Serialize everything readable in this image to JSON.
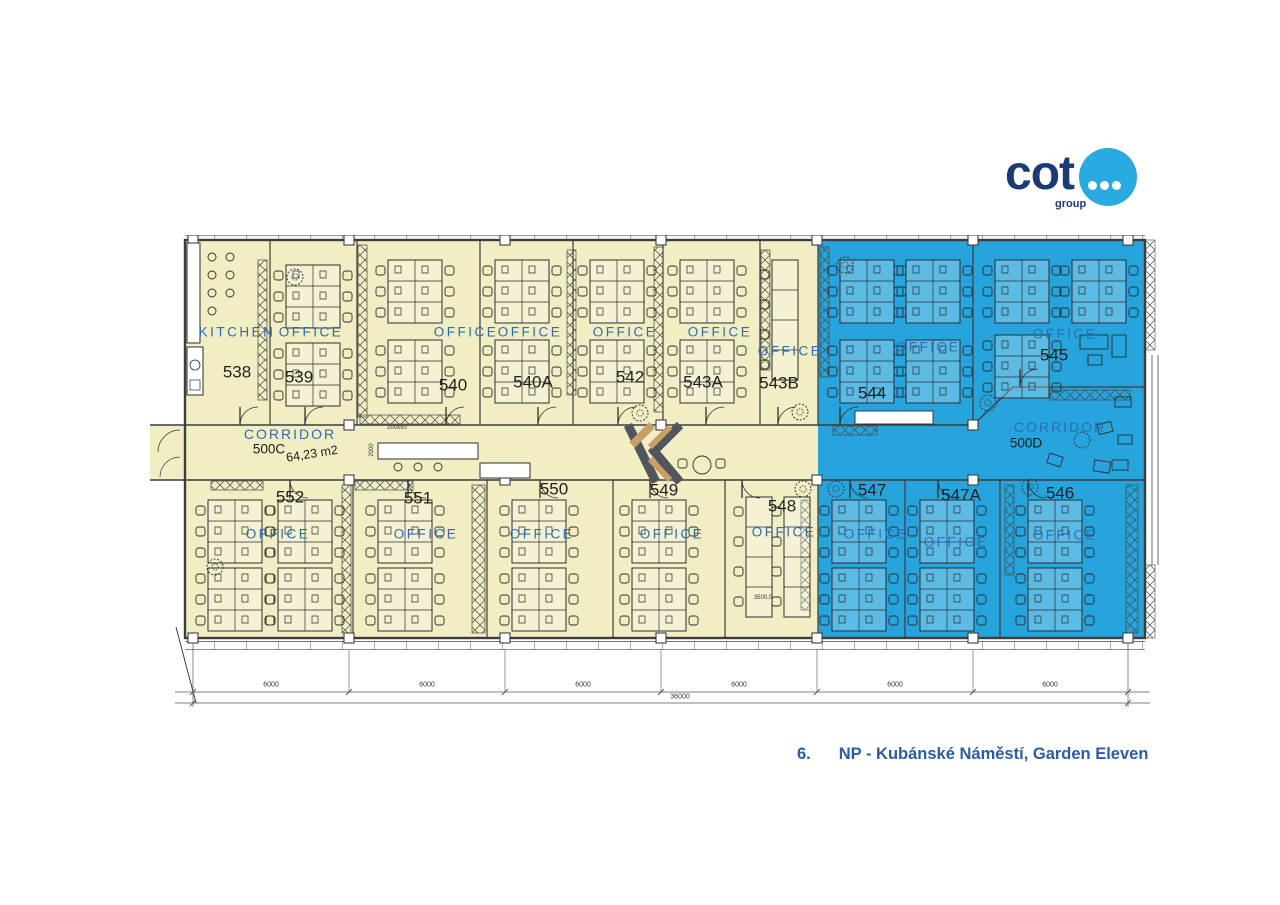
{
  "logo": {
    "brand": "cot",
    "sub": "group",
    "navy": "#1c3b76",
    "blue": "#29abe2"
  },
  "caption": {
    "index": "6.",
    "text": "NP - Kubánské Náměstí, Garden Eleven",
    "color": "#2a5ca8"
  },
  "plan": {
    "colors": {
      "yellow_zone": "#f1eec3",
      "blue_zone": "#25a4dd",
      "label_blue": "#2e6cb4",
      "wall": "#3d3d3d"
    },
    "corridors": {
      "left": {
        "label": "CORRIDOR",
        "number": "500C",
        "area": "64,23 m2"
      },
      "right": {
        "label": "CORRIDOR",
        "number": "500D"
      }
    },
    "rooms_top": [
      {
        "number": "538",
        "type": "KITCHEN",
        "zone": "yellow"
      },
      {
        "number": "539",
        "type": "OFFICE",
        "zone": "yellow"
      },
      {
        "number": "540",
        "type": "OFFICE",
        "zone": "yellow"
      },
      {
        "number": "540A",
        "type": "OFFICE",
        "zone": "yellow"
      },
      {
        "number": "542",
        "type": "OFFICE",
        "zone": "yellow"
      },
      {
        "number": "543A",
        "type": "OFFICE",
        "zone": "yellow"
      },
      {
        "number": "543B",
        "type": "OFFICE",
        "zone": "yellow"
      },
      {
        "number": "544",
        "type": "OFFICE",
        "zone": "blue"
      },
      {
        "number": "545",
        "type": "OFFICE",
        "zone": "blue"
      }
    ],
    "rooms_bottom": [
      {
        "number": "552",
        "type": "OFFICE",
        "zone": "yellow"
      },
      {
        "number": "551",
        "type": "OFFICE",
        "zone": "yellow"
      },
      {
        "number": "550",
        "type": "OFFICE",
        "zone": "yellow"
      },
      {
        "number": "549",
        "type": "OFFICE",
        "zone": "yellow"
      },
      {
        "number": "548",
        "type": "OFFICE",
        "zone": "yellow"
      },
      {
        "number": "547",
        "type": "OFFICE",
        "zone": "blue"
      },
      {
        "number": "547A",
        "type": "OFFICE",
        "zone": "blue"
      },
      {
        "number": "546",
        "type": "OFFICE",
        "zone": "blue"
      }
    ],
    "annotations": {
      "table_dim": "200x50",
      "corridor_width": "2000",
      "room_dim": "3500,0"
    },
    "dimensions": {
      "segment": "6000",
      "total": "36000"
    }
  }
}
